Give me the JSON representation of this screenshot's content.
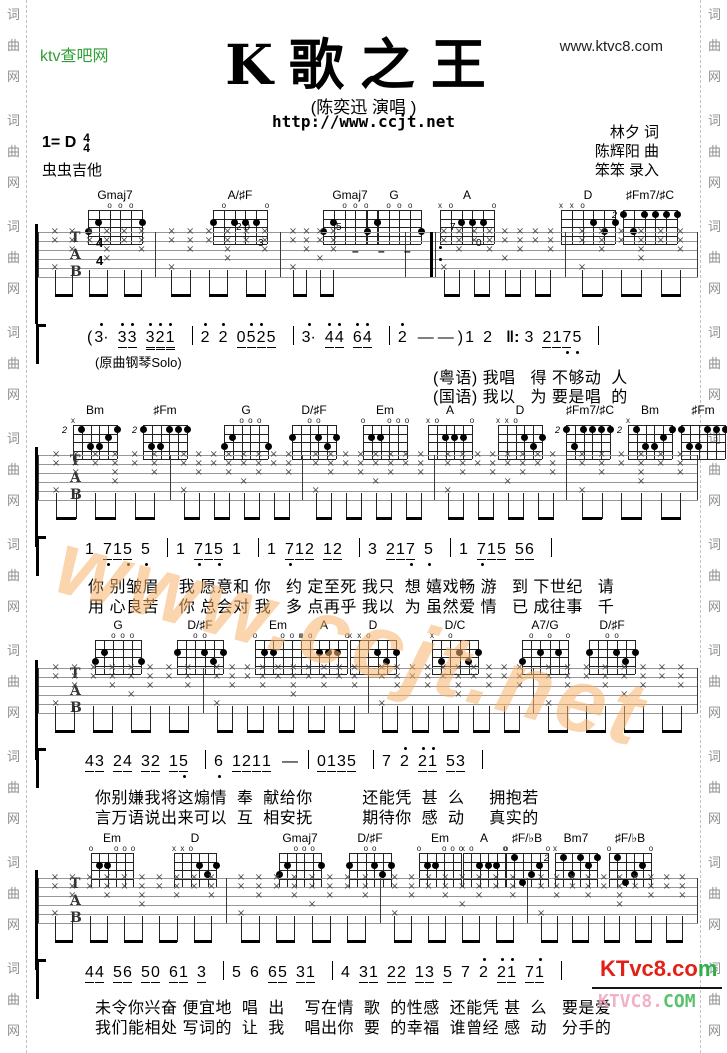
{
  "header": {
    "site_logo": "ktv查吧网",
    "site_url": "www.ktvc8.com",
    "title": "K歌之王",
    "artist": "(陈奕迅 演唱 )",
    "page_url": "http://www.ccjt.net",
    "key_label": "1= D",
    "time_top": "4",
    "time_bottom": "4",
    "source": "虫虫吉他",
    "credits": [
      "林夕 词",
      "陈辉阳 曲",
      "笨笨 录入"
    ]
  },
  "rail_text": [
    "词",
    "曲",
    "网"
  ],
  "watermark": "www.ccjt.net",
  "logo": {
    "line1_red": "KTvc8.co",
    "line1_green": "m",
    "line2_pink": "KTVC8.",
    "line2_green": "COM"
  },
  "chord_shapes": {
    "Gmaj7": {
      "top": [
        "",
        "",
        "o",
        "o",
        "o",
        ""
      ],
      "dots": [
        [
          1,
          3
        ],
        [
          2,
          2
        ],
        [
          6,
          2
        ]
      ]
    },
    "A/♯F": {
      "top": [
        "",
        "o",
        "",
        "",
        "",
        "o"
      ],
      "dots": [
        [
          1,
          2
        ],
        [
          3,
          2
        ],
        [
          4,
          2
        ],
        [
          5,
          2
        ]
      ]
    },
    "G": {
      "top": [
        "",
        "",
        "o",
        "o",
        "o",
        ""
      ],
      "dots": [
        [
          1,
          3
        ],
        [
          2,
          2
        ],
        [
          6,
          3
        ]
      ]
    },
    "A": {
      "top": [
        "x",
        "o",
        "",
        "",
        "",
        "o"
      ],
      "dots": [
        [
          3,
          2
        ],
        [
          4,
          2
        ],
        [
          5,
          2
        ]
      ]
    },
    "D": {
      "top": [
        "x",
        "x",
        "o",
        "",
        "",
        ""
      ],
      "dots": [
        [
          4,
          2
        ],
        [
          6,
          2
        ],
        [
          5,
          3
        ]
      ]
    },
    "♯Fm7/♯C": {
      "pos": "2",
      "dots": [
        [
          1,
          1
        ],
        [
          3,
          1
        ],
        [
          4,
          1
        ],
        [
          5,
          1
        ],
        [
          6,
          1
        ],
        [
          2,
          3
        ]
      ]
    },
    "Bm": {
      "pos": "2",
      "top": [
        "x",
        "",
        "",
        "",
        "",
        ""
      ],
      "dots": [
        [
          2,
          1
        ],
        [
          6,
          1
        ],
        [
          3,
          3
        ],
        [
          4,
          3
        ],
        [
          5,
          2
        ]
      ]
    },
    "♯Fm": {
      "pos": "2",
      "dots": [
        [
          1,
          1
        ],
        [
          4,
          1
        ],
        [
          5,
          1
        ],
        [
          6,
          1
        ],
        [
          2,
          3
        ],
        [
          3,
          3
        ]
      ]
    },
    "D/♯F": {
      "top": [
        "",
        "",
        "o",
        "o",
        "",
        ""
      ],
      "dots": [
        [
          1,
          2
        ],
        [
          4,
          2
        ],
        [
          6,
          2
        ],
        [
          5,
          3
        ]
      ]
    },
    "Em": {
      "top": [
        "o",
        "",
        "",
        "o",
        "o",
        "o"
      ],
      "dots": [
        [
          2,
          2
        ],
        [
          3,
          2
        ]
      ]
    },
    "D/C": {
      "top": [
        "x",
        "",
        "o",
        "",
        "",
        ""
      ],
      "dots": [
        [
          2,
          3
        ],
        [
          4,
          2
        ],
        [
          6,
          2
        ],
        [
          5,
          3
        ]
      ]
    },
    "A7/G": {
      "top": [
        "",
        "o",
        "",
        "o",
        "",
        "o"
      ],
      "dots": [
        [
          1,
          3
        ],
        [
          3,
          2
        ],
        [
          5,
          2
        ]
      ]
    },
    "Bm7": {
      "pos": "2",
      "top": [
        "x",
        "",
        "",
        "",
        "",
        ""
      ],
      "dots": [
        [
          2,
          1
        ],
        [
          3,
          3
        ],
        [
          4,
          1
        ],
        [
          5,
          2
        ],
        [
          6,
          1
        ]
      ]
    },
    "♯F/♭B": {
      "top": [
        "o",
        "",
        "",
        "",
        "",
        "o"
      ],
      "dots": [
        [
          2,
          1
        ],
        [
          5,
          2
        ],
        [
          3,
          4
        ],
        [
          4,
          3
        ]
      ]
    }
  },
  "sections": [
    {
      "chords": [
        [
          "Gmaj7",
          115
        ],
        [
          "A/♯F",
          240
        ],
        [
          "Gmaj7",
          350
        ],
        [
          "G",
          394
        ],
        [
          "A",
          467
        ],
        [
          "D",
          588
        ],
        [
          "♯Fm7/♯C",
          650
        ]
      ],
      "notation": [
        [
          "(",
          "s"
        ],
        [
          "3",
          "hd"
        ],
        [
          "3",
          "hut"
        ],
        [
          "3",
          "hu"
        ],
        [
          "3",
          "hUt"
        ],
        [
          "2",
          "hUt"
        ],
        [
          "1",
          "hU"
        ],
        [
          "|",
          "B"
        ],
        [
          "2",
          "h"
        ],
        [
          "2",
          "h"
        ],
        [
          "0",
          "ut"
        ],
        [
          "5",
          "hut"
        ],
        [
          "2",
          "hut"
        ],
        [
          "5",
          "u"
        ],
        [
          "|",
          "B"
        ],
        [
          "3",
          "hd"
        ],
        [
          "4",
          "hut"
        ],
        [
          "4",
          "hu"
        ],
        [
          "6",
          "hut"
        ],
        [
          "4",
          "hu"
        ],
        [
          "|",
          "B"
        ],
        [
          "2",
          "h"
        ],
        [
          "—",
          "D"
        ],
        [
          "—",
          "D"
        ],
        [
          ")",
          "s"
        ],
        [
          "1",
          ""
        ],
        [
          "2",
          ""
        ],
        [
          "‖:",
          "R"
        ],
        [
          "3",
          ""
        ],
        [
          "2",
          "ut"
        ],
        [
          "1",
          "ut"
        ],
        [
          "7",
          "ubt"
        ],
        [
          "5",
          "b"
        ],
        [
          "|",
          "B"
        ]
      ],
      "solo_note": "(原曲钢琴Solo)",
      "lyrics": [
        "(粤语) 我唱   得 不够动  人",
        "(国语) 我以   为 要是唱  的"
      ]
    },
    {
      "chords": [
        [
          "Bm",
          95
        ],
        [
          "♯Fm",
          165
        ],
        [
          "G",
          246
        ],
        [
          "D/♯F",
          314
        ],
        [
          "Em",
          385
        ],
        [
          "A",
          450
        ],
        [
          "D",
          520
        ],
        [
          "♯Fm7/♯C",
          588
        ],
        [
          "Bm",
          650
        ],
        [
          "♯Fm",
          703
        ]
      ],
      "notation": [
        [
          "1",
          ""
        ],
        [
          "7",
          "ubt"
        ],
        [
          "1",
          "ut"
        ],
        [
          "5",
          "ub"
        ],
        [
          "5",
          "b"
        ],
        [
          "|",
          "B"
        ],
        [
          "1",
          ""
        ],
        [
          "7",
          "ubt"
        ],
        [
          "1",
          "ut"
        ],
        [
          "5",
          "ub"
        ],
        [
          "1",
          ""
        ],
        [
          "|",
          "B"
        ],
        [
          "1",
          ""
        ],
        [
          "7",
          "ubt"
        ],
        [
          "1",
          "ut"
        ],
        [
          "2",
          "u"
        ],
        [
          "1",
          "ut"
        ],
        [
          "2",
          "u"
        ],
        [
          "|",
          "B"
        ],
        [
          "3",
          ""
        ],
        [
          "2",
          "ut"
        ],
        [
          "1",
          "ut"
        ],
        [
          "7",
          "ub"
        ],
        [
          "5",
          "b"
        ],
        [
          "|",
          "B"
        ],
        [
          "1",
          ""
        ],
        [
          "7",
          "ubt"
        ],
        [
          "1",
          "ut"
        ],
        [
          "5",
          "u"
        ],
        [
          "5",
          "ut"
        ],
        [
          "6",
          "u"
        ],
        [
          "|",
          "B"
        ]
      ],
      "lyrics": [
        "你 别皱眉    我 愿意和 你   约 定至死 我只  想 嬉戏畅 游   到 下世纪   请",
        "用 心良苦    你 总会对 我   多 点再乎 我以  为 虽然爱 情   已 成往事   千"
      ]
    },
    {
      "chords": [
        [
          "G",
          118
        ],
        [
          "D/♯F",
          200
        ],
        [
          "Em",
          278
        ],
        [
          "A",
          324
        ],
        [
          "D",
          373
        ],
        [
          "D/C",
          455
        ],
        [
          "A7/G",
          545
        ],
        [
          "D/♯F",
          612
        ]
      ],
      "notation": [
        [
          "4",
          "ut"
        ],
        [
          "3",
          "u"
        ],
        [
          "2",
          "ut"
        ],
        [
          "4",
          "u"
        ],
        [
          "3",
          "ut"
        ],
        [
          "2",
          "u"
        ],
        [
          "1",
          "ut"
        ],
        [
          "5",
          "ub"
        ],
        [
          "|",
          "B"
        ],
        [
          "6",
          "b"
        ],
        [
          "1",
          "ut"
        ],
        [
          "2",
          "ut"
        ],
        [
          "1",
          "ut"
        ],
        [
          "1",
          "u"
        ],
        [
          "—",
          "D"
        ],
        [
          "|",
          "B"
        ],
        [
          "0",
          "ut"
        ],
        [
          "1",
          "ut"
        ],
        [
          "3",
          "ut"
        ],
        [
          "5",
          "u"
        ],
        [
          "|",
          "B"
        ],
        [
          "7",
          ""
        ],
        [
          "2",
          "h"
        ],
        [
          "2",
          "hut"
        ],
        [
          "1",
          "hu"
        ],
        [
          "5",
          "ut"
        ],
        [
          "3",
          "u"
        ],
        [
          "|",
          "B"
        ]
      ],
      "lyrics": [
        "你别嫌我将这煽情  奉  献给你          还能凭  甚  么     拥抱若",
        "言万语说出来可以  互  相安抚          期待你  感  动     真实的"
      ]
    },
    {
      "chords": [
        [
          "Em",
          112
        ],
        [
          "D",
          195
        ],
        [
          "Gmaj7",
          300
        ],
        [
          "D/♯F",
          370
        ],
        [
          "Em",
          440
        ],
        [
          "A",
          484
        ],
        [
          "♯F/♭B",
          527
        ],
        [
          "Bm7",
          576
        ],
        [
          "♯F/♭B",
          630
        ]
      ],
      "notation": [
        [
          "4",
          "ut"
        ],
        [
          "4",
          "u"
        ],
        [
          "5",
          "ut"
        ],
        [
          "6",
          "u"
        ],
        [
          "5",
          "ut"
        ],
        [
          "0",
          "u"
        ],
        [
          "6",
          "ut"
        ],
        [
          "1",
          "u"
        ],
        [
          "3",
          "u"
        ],
        [
          "|",
          "B"
        ],
        [
          "5",
          ""
        ],
        [
          "6",
          ""
        ],
        [
          "6",
          "ut"
        ],
        [
          "5",
          "u"
        ],
        [
          "3",
          "ut"
        ],
        [
          "1",
          "u"
        ],
        [
          "|",
          "B"
        ],
        [
          "4",
          ""
        ],
        [
          "3",
          "ut"
        ],
        [
          "1",
          "u"
        ],
        [
          "2",
          "ut"
        ],
        [
          "2",
          "u"
        ],
        [
          "1",
          "ut"
        ],
        [
          "3",
          "u"
        ],
        [
          "5",
          "u"
        ],
        [
          "7",
          ""
        ],
        [
          "2",
          "h"
        ],
        [
          "2",
          "hut"
        ],
        [
          "1",
          "hu"
        ],
        [
          "7",
          "ut"
        ],
        [
          "1",
          "hu"
        ],
        [
          "|",
          "B"
        ]
      ],
      "lyrics": [
        "未令你兴奋 便宜地  唱  出    写在情  歌  的性感  还能凭 甚  么   要是爱",
        "我们能相处 写词的  让  我    唱出你  要  的幸福  谁曾经 感  动   分手的"
      ]
    }
  ]
}
